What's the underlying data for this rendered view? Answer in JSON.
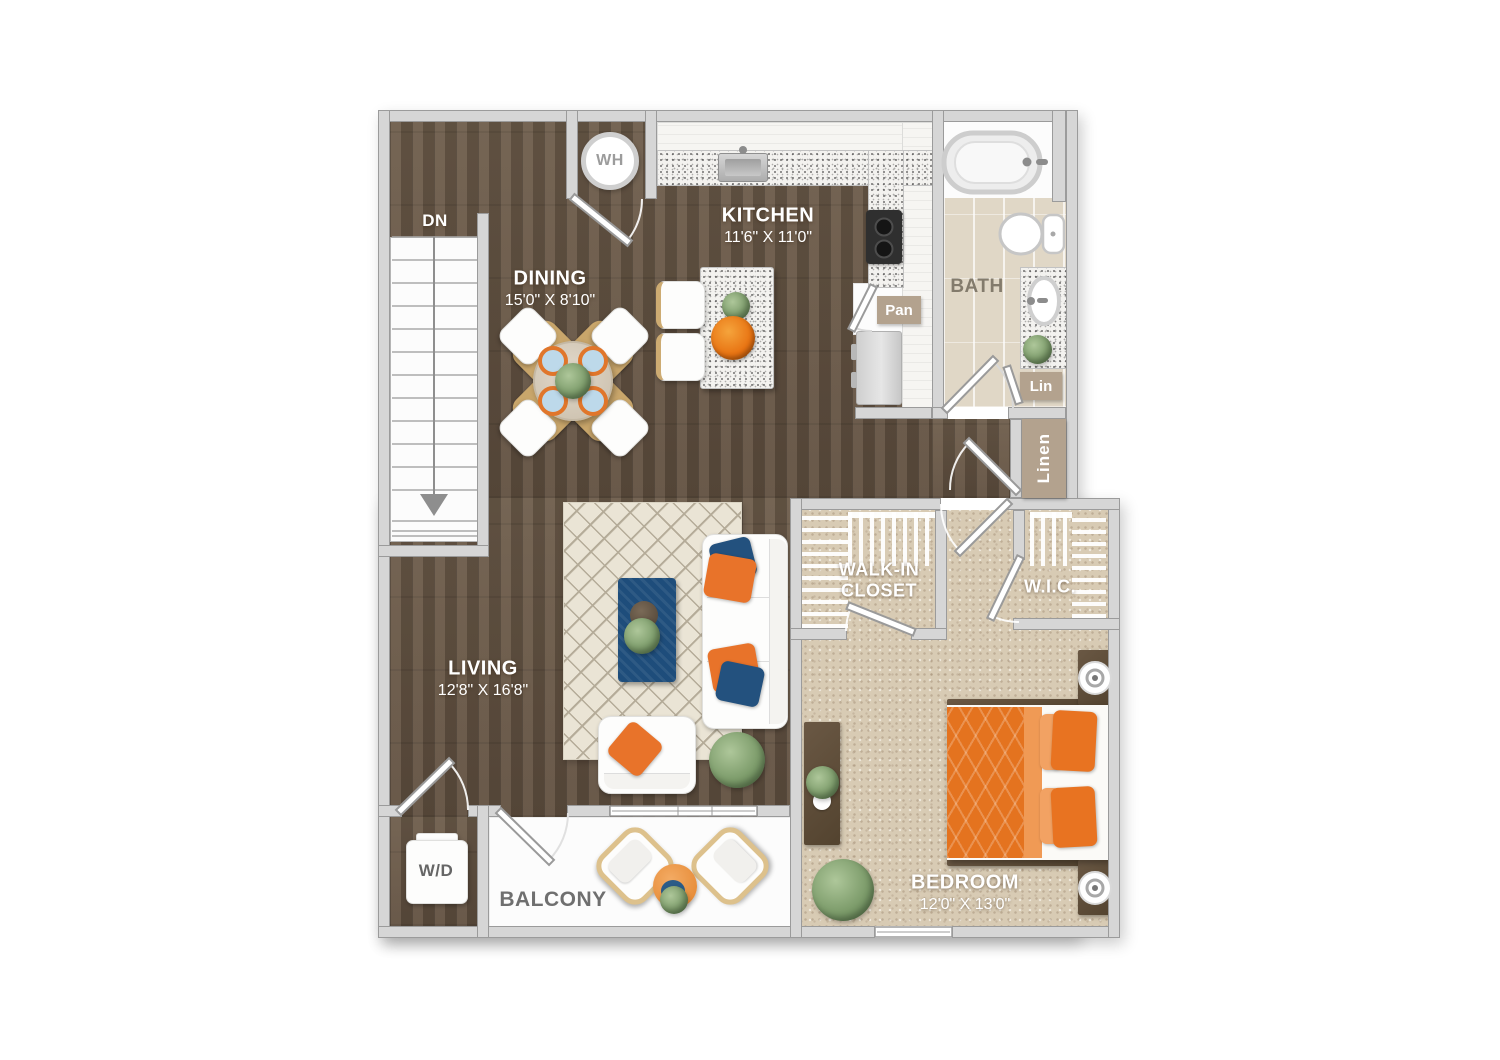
{
  "rooms": {
    "dining": {
      "label": "DINING",
      "dims": "15'0\" X 8'10\""
    },
    "kitchen": {
      "label": "KITCHEN",
      "dims": "11'6\" X 11'0\""
    },
    "living": {
      "label": "LIVING",
      "dims": "12'8\" X 16'8\""
    },
    "bedroom": {
      "label": "BEDROOM",
      "dims": "12'0\" X 13'0\""
    },
    "bath": {
      "label": "BATH"
    },
    "walk_in_closet": {
      "line1": "WALK-IN",
      "line2": "CLOSET"
    },
    "wic": {
      "label": "W.I.C."
    },
    "balcony": {
      "label": "BALCONY"
    }
  },
  "fixtures": {
    "stairs_down": "DN",
    "water_heater": "WH",
    "pantry": "Pan",
    "linen_small": "Lin",
    "linen_closet": "Linen",
    "washer_dryer": "W/D"
  },
  "colors": {
    "accent_orange": "#e8772a",
    "navy_blue": "#1e4d7b",
    "wood_floor": "#665746",
    "carpet": "#d8cbb4",
    "bath_tile": "#e0d7c6",
    "wall_gray": "#d6d6d6",
    "tan_label": "#b3a28e"
  }
}
